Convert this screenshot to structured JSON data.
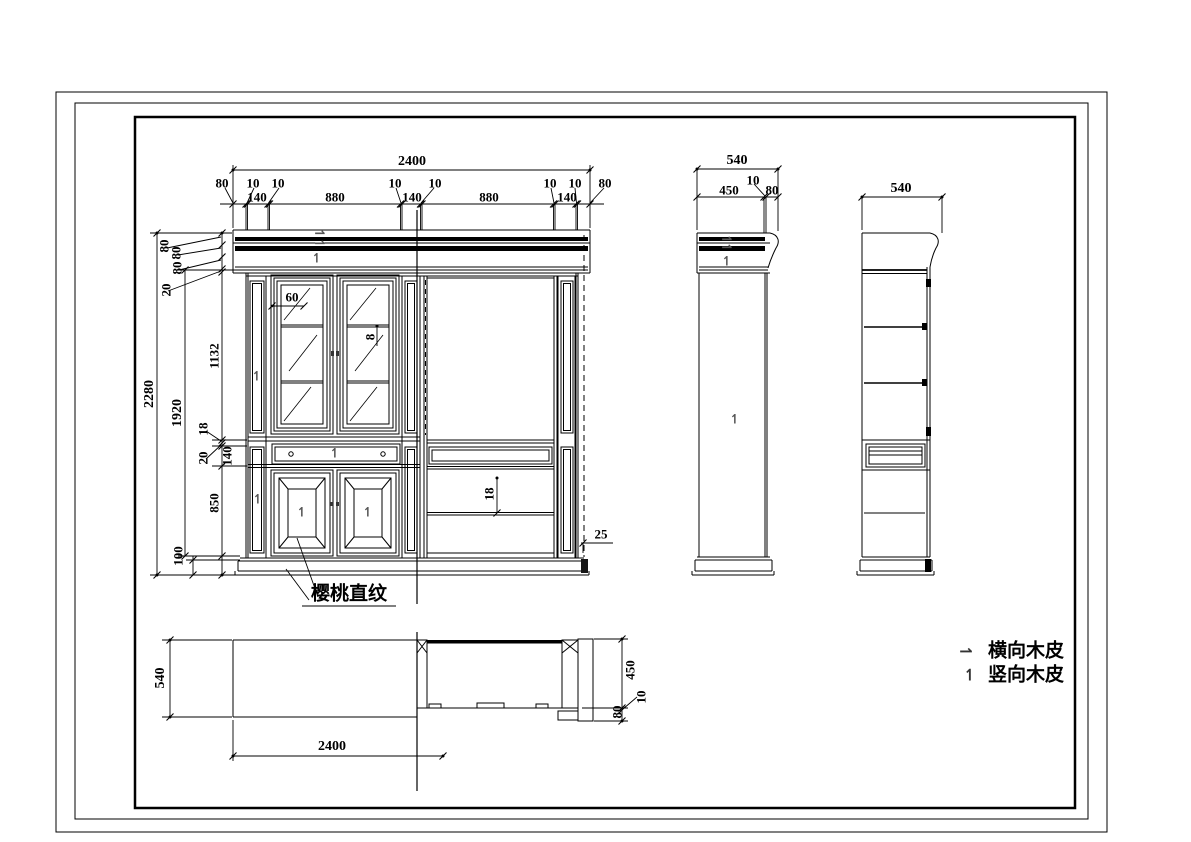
{
  "material_note": "樱桃直纹",
  "legend": {
    "horizontal_symbol": "⇀",
    "horizontal_label": "横向木皮",
    "vertical_symbol": "↿",
    "vertical_label": "竖向木皮"
  },
  "symbols": {
    "h": "⇀",
    "v": "↿"
  },
  "front": {
    "overall_width": "2400",
    "top_labels": [
      "80",
      "10",
      "10",
      "10",
      "10",
      "10",
      "10",
      "80"
    ],
    "mid_labels": [
      "140",
      "880",
      "140",
      "880",
      "140"
    ],
    "left": {
      "overall": "2280",
      "upper": "1920",
      "crown": [
        "80",
        "80",
        "80",
        "20"
      ],
      "glass": "1132",
      "shelf": "18",
      "gap": "20",
      "drawer": "140",
      "lower": "850",
      "plinth": "100"
    },
    "details": {
      "stile": "60",
      "glass_shelf": "8",
      "shelf_thickness": "18",
      "edge": "25"
    }
  },
  "side": {
    "overall_width": "540",
    "depth": "450",
    "gap": "10",
    "edge": "80"
  },
  "section_side": {
    "overall_width": "540"
  },
  "plan": {
    "depth": "540",
    "overall_width": "2400",
    "inner_depth": "450",
    "gap": "10",
    "edge": "80"
  }
}
